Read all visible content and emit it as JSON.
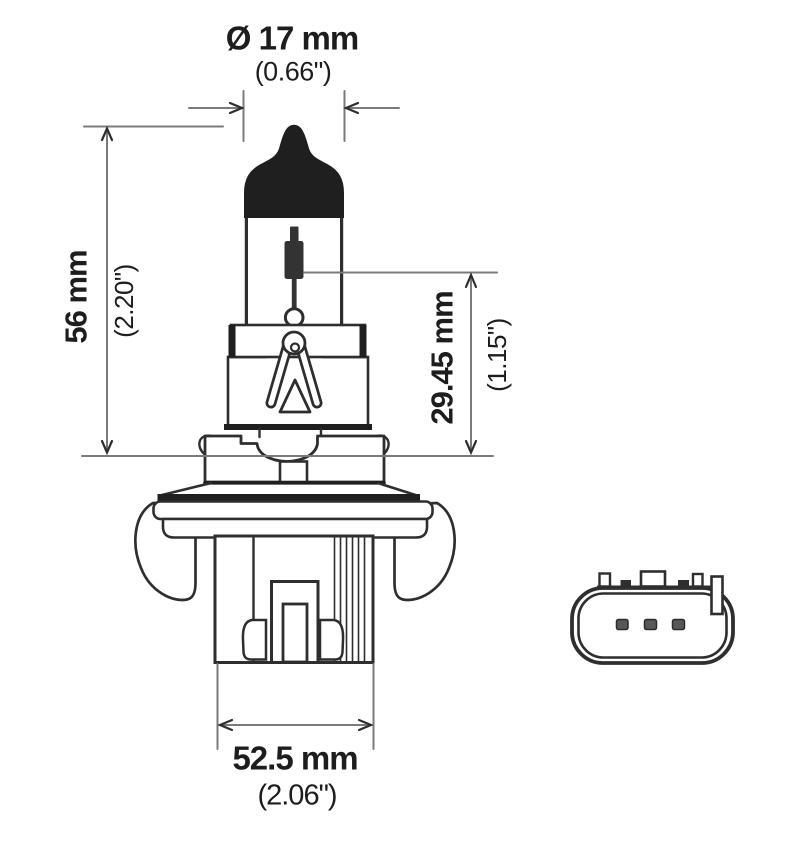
{
  "drawing": {
    "title": "Halogen headlight bulb dimensional diagram (side view and connector end view)",
    "colors": {
      "outline": "#2e2e2e",
      "solid_fill": "#1f1f1f",
      "dimension_line": "#7b7b7b",
      "text": "#1d1d1d",
      "background": "#ffffff"
    },
    "dimensions": {
      "diameter": {
        "mm": "Ø 17 mm",
        "inch": "(0.66\")"
      },
      "overall": {
        "mm": "56 mm",
        "inch": "(2.20\")"
      },
      "filament": {
        "mm": "29.45 mm",
        "inch": "(1.15\")"
      },
      "base_width": {
        "mm": "52.5 mm",
        "inch": "(2.06\")"
      }
    },
    "connector": {
      "pin_count": 3
    }
  }
}
